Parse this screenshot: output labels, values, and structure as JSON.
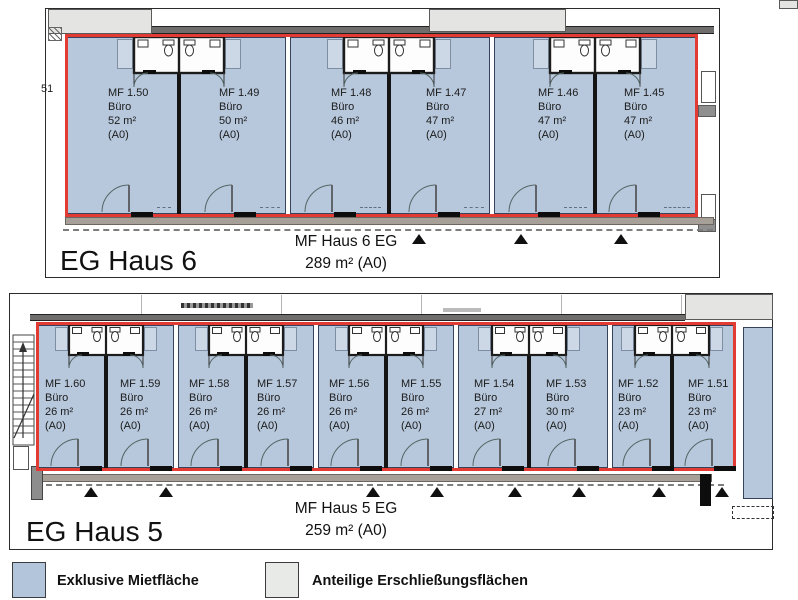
{
  "haus6": {
    "panel_label": "EG Haus 6",
    "summary": {
      "line1": "MF Haus 6 EG",
      "line2": "289 m² (A0)"
    },
    "side_label": "51",
    "units": [
      {
        "id": "MF 1.50",
        "type": "Büro",
        "area": "52 m²",
        "zone": "(A0)"
      },
      {
        "id": "MF 1.49",
        "type": "Büro",
        "area": "50 m²",
        "zone": "(A0)"
      },
      {
        "id": "MF 1.48",
        "type": "Büro",
        "area": "46 m²",
        "zone": "(A0)"
      },
      {
        "id": "MF 1.47",
        "type": "Büro",
        "area": "47 m²",
        "zone": "(A0)"
      },
      {
        "id": "MF 1.46",
        "type": "Büro",
        "area": "47 m²",
        "zone": "(A0)"
      },
      {
        "id": "MF 1.45",
        "type": "Büro",
        "area": "47 m²",
        "zone": "(A0)"
      }
    ]
  },
  "haus5": {
    "panel_label": "EG Haus 5",
    "summary": {
      "line1": "MF Haus 5 EG",
      "line2": "259 m² (A0)"
    },
    "units": [
      {
        "id": "MF 1.60",
        "type": "Büro",
        "area": "26 m²",
        "zone": "(A0)"
      },
      {
        "id": "MF 1.59",
        "type": "Büro",
        "area": "26 m²",
        "zone": "(A0)"
      },
      {
        "id": "MF 1.58",
        "type": "Büro",
        "area": "26 m²",
        "zone": "(A0)"
      },
      {
        "id": "MF 1.57",
        "type": "Büro",
        "area": "26 m²",
        "zone": "(A0)"
      },
      {
        "id": "MF 1.56",
        "type": "Büro",
        "area": "26 m²",
        "zone": "(A0)"
      },
      {
        "id": "MF 1.55",
        "type": "Büro",
        "area": "26 m²",
        "zone": "(A0)"
      },
      {
        "id": "MF 1.54",
        "type": "Büro",
        "area": "27 m²",
        "zone": "(A0)"
      },
      {
        "id": "MF 1.53",
        "type": "Büro",
        "area": "30 m²",
        "zone": "(A0)"
      },
      {
        "id": "MF 1.52",
        "type": "Büro",
        "area": "23 m²",
        "zone": "(A0)"
      },
      {
        "id": "MF 1.51",
        "type": "Büro",
        "area": "23 m²",
        "zone": "(A0)"
      }
    ]
  },
  "legend": {
    "items": [
      {
        "label": "Exklusive Mietfläche",
        "color": "#b3c5da"
      },
      {
        "label": "Anteilige Erschließungsflächen",
        "color": "#e8eae8"
      }
    ]
  },
  "colors": {
    "unit_fill": "#b7c8dc",
    "boundary_red": "#e23b33"
  }
}
